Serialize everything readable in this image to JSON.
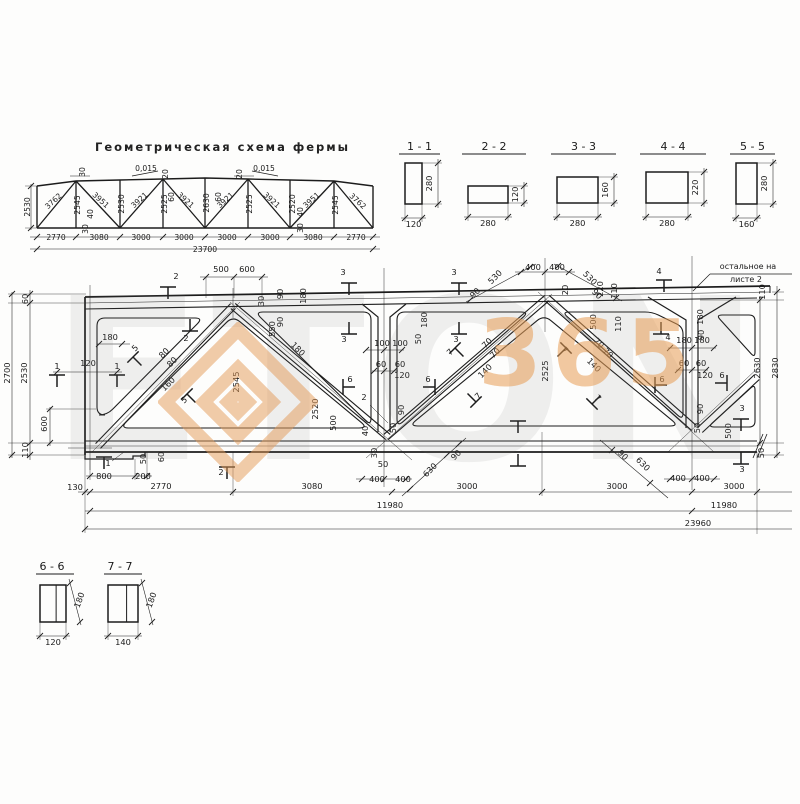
{
  "page": {
    "ink": "#1c1c1c",
    "accent_orange": "#e59a55",
    "background": "#fdfdfc"
  },
  "watermark": {
    "big_text": "ETON",
    "digits": "365"
  },
  "scheme": {
    "title": "Геометрическая схема фермы",
    "total_label": "23700",
    "labels": [
      [
        "2770",
        56,
        240,
        0
      ],
      [
        "3080",
        99,
        240,
        0
      ],
      [
        "3000",
        141,
        240,
        0
      ],
      [
        "3000",
        184,
        240,
        0
      ],
      [
        "3000",
        227,
        240,
        0
      ],
      [
        "3000",
        270,
        240,
        0
      ],
      [
        "3080",
        313,
        240,
        0
      ],
      [
        "2770",
        356,
        240,
        0
      ],
      [
        "23700",
        205,
        252,
        0
      ],
      [
        "2530",
        30,
        207,
        -90
      ],
      [
        "2545",
        80,
        205,
        -90
      ],
      [
        "2530",
        124,
        204,
        -90
      ],
      [
        "2525",
        167,
        204,
        -90
      ],
      [
        "2630",
        209,
        203,
        -90
      ],
      [
        "2525",
        252,
        204,
        -90
      ],
      [
        "2520",
        295,
        204,
        -90
      ],
      [
        "2545",
        338,
        205,
        -90
      ],
      [
        "3762",
        55,
        203,
        -42
      ],
      [
        "3951",
        99,
        202,
        42
      ],
      [
        "3921",
        141,
        202,
        -42
      ],
      [
        "3921",
        184,
        202,
        42
      ],
      [
        "3921",
        227,
        202,
        -42
      ],
      [
        "3921",
        270,
        202,
        42
      ],
      [
        "3951",
        313,
        202,
        -42
      ],
      [
        "3762",
        356,
        203,
        42
      ],
      [
        "30",
        85,
        172,
        -90
      ],
      [
        "0,015",
        146,
        171,
        0
      ],
      [
        "20",
        168,
        174,
        -90
      ],
      [
        "60",
        174,
        197,
        -90
      ],
      [
        "20",
        242,
        174,
        -90
      ],
      [
        "0,015",
        264,
        171,
        0
      ],
      [
        "60",
        221,
        197,
        -90
      ],
      [
        "40",
        93,
        214,
        -90
      ],
      [
        "30",
        88,
        229,
        -90
      ],
      [
        "40",
        303,
        212,
        -90
      ],
      [
        "30",
        303,
        228,
        -90
      ]
    ]
  },
  "sections_top": [
    {
      "title": "1 - 1",
      "width_label": "120",
      "height_label": "280"
    },
    {
      "title": "2 - 2",
      "width_label": "280",
      "height_label": "120"
    },
    {
      "title": "3 - 3",
      "width_label": "280",
      "height_label": "160"
    },
    {
      "title": "4 - 4",
      "width_label": "280",
      "height_label": "220"
    },
    {
      "title": "5 - 5",
      "width_label": "160",
      "height_label": "280"
    }
  ],
  "sections_bottom": [
    {
      "title": "6 - 6",
      "width_label": "120",
      "height_label": "180"
    },
    {
      "title": "7 - 7",
      "width_label": "140",
      "height_label": "180"
    }
  ],
  "elevation": {
    "note_line1": "остальное на",
    "note_line2": "листе 2",
    "labels": [
      [
        "60",
        28,
        299,
        -90
      ],
      [
        "2530",
        27,
        373,
        -90
      ],
      [
        "2700",
        10,
        373,
        -90
      ],
      [
        "110",
        28,
        450,
        -90
      ],
      [
        "600",
        47,
        424,
        -90
      ],
      [
        "180",
        110,
        340,
        0
      ],
      [
        "120",
        88,
        366,
        0
      ],
      [
        "1",
        57,
        369,
        0
      ],
      [
        "1",
        117,
        369,
        0
      ],
      [
        "1",
        108,
        466,
        0
      ],
      [
        "5",
        137,
        350,
        -45
      ],
      [
        "5",
        186,
        402,
        -45
      ],
      [
        "2",
        176,
        279,
        0
      ],
      [
        "2",
        186,
        341,
        0
      ],
      [
        "2",
        221,
        475,
        0
      ],
      [
        "2",
        364,
        400,
        0
      ],
      [
        "500",
        221,
        272,
        0
      ],
      [
        "600",
        247,
        272,
        0
      ],
      [
        "30",
        264,
        301,
        -90
      ],
      [
        "80",
        166,
        355,
        -45
      ],
      [
        "80",
        174,
        364,
        -45
      ],
      [
        "160",
        170,
        386,
        -45
      ],
      [
        "90",
        283,
        294,
        -90
      ],
      [
        "180",
        306,
        296,
        -90
      ],
      [
        "90",
        283,
        322,
        -90
      ],
      [
        "550",
        275,
        329,
        -90
      ],
      [
        "180",
        296,
        351,
        45
      ],
      [
        "2545",
        239,
        382,
        -90
      ],
      [
        "2520",
        318,
        409,
        -90
      ],
      [
        "500",
        336,
        423,
        -90
      ],
      [
        "3",
        343,
        275,
        0
      ],
      [
        "3",
        454,
        275,
        0
      ],
      [
        "3",
        344,
        342,
        0
      ],
      [
        "3",
        456,
        342,
        0
      ],
      [
        "100",
        382,
        346,
        0
      ],
      [
        "100",
        400,
        346,
        0
      ],
      [
        "180",
        427,
        320,
        -90
      ],
      [
        "50",
        421,
        339,
        -90
      ],
      [
        "60",
        381,
        367,
        0
      ],
      [
        "60",
        400,
        367,
        0
      ],
      [
        "120",
        402,
        378,
        0
      ],
      [
        "6",
        350,
        382,
        0
      ],
      [
        "6",
        428,
        382,
        0
      ],
      [
        "90",
        404,
        410,
        -90
      ],
      [
        "50",
        396,
        428,
        -90
      ],
      [
        "40",
        368,
        431,
        -90
      ],
      [
        "30",
        377,
        453,
        -90
      ],
      [
        "50",
        383,
        467,
        0
      ],
      [
        "400",
        377,
        482,
        0
      ],
      [
        "400",
        403,
        482,
        0
      ],
      [
        "630",
        432,
        472,
        -45
      ],
      [
        "90",
        458,
        457,
        -45
      ],
      [
        "70",
        489,
        345,
        -45
      ],
      [
        "70",
        497,
        355,
        -45
      ],
      [
        "140",
        487,
        373,
        -45
      ],
      [
        "7",
        452,
        354,
        -45
      ],
      [
        "7",
        480,
        398,
        -45
      ],
      [
        "530",
        497,
        279,
        -45
      ],
      [
        "90",
        477,
        295,
        -45
      ],
      [
        "400",
        533,
        270,
        0
      ],
      [
        "400",
        557,
        270,
        0
      ],
      [
        "20",
        568,
        290,
        -90
      ],
      [
        "530",
        588,
        280,
        45
      ],
      [
        "90",
        595,
        296,
        45
      ],
      [
        "2525",
        548,
        371,
        -90
      ],
      [
        "70",
        597,
        345,
        45
      ],
      [
        "70",
        606,
        355,
        45
      ],
      [
        "140",
        592,
        367,
        45
      ],
      [
        "7",
        563,
        352,
        45
      ],
      [
        "7",
        596,
        400,
        45
      ],
      [
        "630",
        641,
        466,
        45
      ],
      [
        "90",
        621,
        457,
        45
      ],
      [
        "220",
        603,
        289,
        -90
      ],
      [
        "110",
        617,
        291,
        -90
      ],
      [
        "500",
        596,
        322,
        -90
      ],
      [
        "110",
        621,
        324,
        -90
      ],
      [
        "4",
        659,
        274,
        0
      ],
      [
        "4",
        668,
        340,
        0
      ],
      [
        "180",
        703,
        317,
        -90
      ],
      [
        "90",
        704,
        335,
        -90
      ],
      [
        "180",
        684,
        343,
        0
      ],
      [
        "180",
        702,
        343,
        0
      ],
      [
        "60",
        684,
        366,
        0
      ],
      [
        "60",
        701,
        366,
        0
      ],
      [
        "120",
        705,
        378,
        0
      ],
      [
        "6",
        662,
        382,
        0
      ],
      [
        "6",
        722,
        378,
        0
      ],
      [
        "90",
        703,
        409,
        -90
      ],
      [
        "50",
        700,
        428,
        -90
      ],
      [
        "500",
        731,
        431,
        -90
      ],
      [
        "400",
        678,
        481,
        0
      ],
      [
        "400",
        702,
        481,
        0
      ],
      [
        "3",
        742,
        411,
        0
      ],
      [
        "3",
        742,
        472,
        0
      ],
      [
        "110",
        765,
        292,
        -90
      ],
      [
        "2630",
        760,
        368,
        -90
      ],
      [
        "2830",
        778,
        368,
        -90
      ],
      [
        "50",
        764,
        453,
        -90
      ],
      [
        "50",
        146,
        459,
        -90
      ],
      [
        "60",
        164,
        457,
        -90
      ],
      [
        "800",
        104,
        479,
        0
      ],
      [
        "200",
        143,
        479,
        0
      ],
      [
        "130",
        75,
        490,
        0
      ],
      [
        "2770",
        161,
        489,
        0
      ],
      [
        "3080",
        312,
        489,
        0
      ],
      [
        "3000",
        467,
        489,
        0
      ],
      [
        "3000",
        617,
        489,
        0
      ],
      [
        "3000",
        734,
        489,
        0
      ],
      [
        "11980",
        390,
        508,
        0
      ],
      [
        "11980",
        724,
        508,
        0
      ],
      [
        "23960",
        698,
        526,
        0
      ]
    ]
  }
}
